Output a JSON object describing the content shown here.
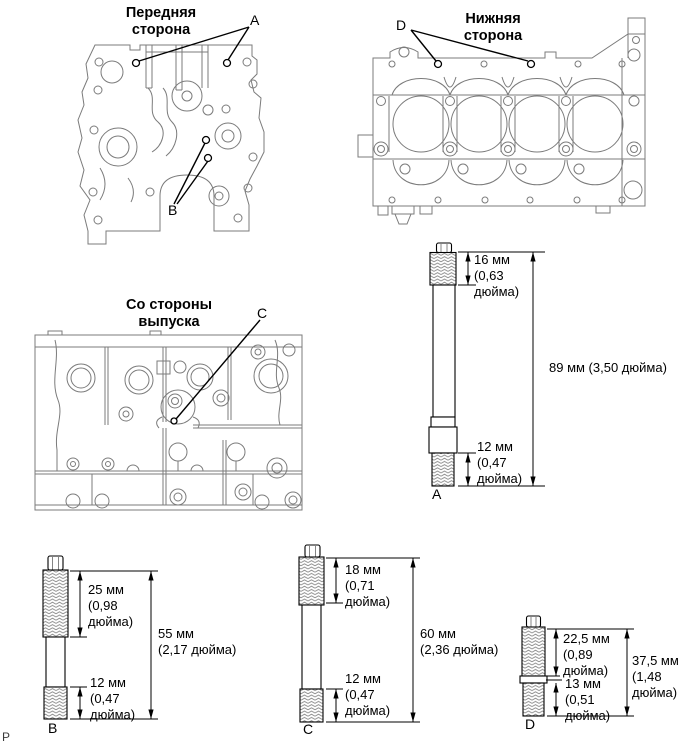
{
  "page": {
    "marker": "P"
  },
  "diagrams": {
    "front": {
      "title": [
        "Передняя",
        "сторона"
      ],
      "labels": {
        "a": "A",
        "b": "B"
      }
    },
    "bottom": {
      "title": [
        "Нижняя",
        "сторона"
      ],
      "labels": {
        "d": "D"
      }
    },
    "exhaust": {
      "title": [
        "Со стороны",
        "выпуска"
      ],
      "labels": {
        "c": "C"
      }
    }
  },
  "studs": {
    "a": {
      "label": "A",
      "top_dim": [
        "16 мм",
        "(0,63",
        "дюйма)"
      ],
      "total_dim": [
        "89 мм (3,50 дюйма)"
      ],
      "bottom_dim": [
        "12 мм",
        "(0,47",
        "дюйма)"
      ]
    },
    "b": {
      "label": "B",
      "top_dim": [
        "25 мм",
        "(0,98",
        "дюйма)"
      ],
      "total_dim": [
        "55 мм",
        "(2,17 дюйма)"
      ],
      "bottom_dim": [
        "12 мм",
        "(0,47",
        "дюйма)"
      ]
    },
    "c": {
      "label": "C",
      "top_dim": [
        "18 мм",
        "(0,71",
        "дюйма)"
      ],
      "total_dim": [
        "60 мм",
        "(2,36 дюйма)"
      ],
      "bottom_dim": [
        "12 мм",
        "(0,47",
        "дюйма)"
      ]
    },
    "d": {
      "label": "D",
      "top_dim": [
        "22,5 мм",
        "(0,89",
        "дюйма)"
      ],
      "mid_dim": [
        "13 мм",
        "(0,51",
        "дюйма)"
      ],
      "total_dim": [
        "37,5 мм",
        "(1,48",
        "дюйма)"
      ]
    }
  }
}
